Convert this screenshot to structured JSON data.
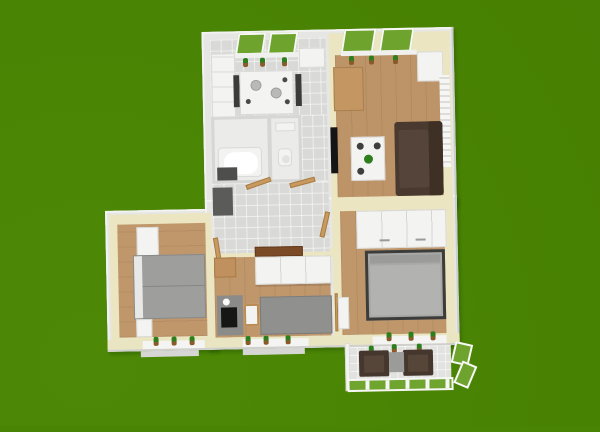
{
  "scene": {
    "view": "3d-aerial-floorplan-render",
    "background_color": "#4a8404",
    "palette": {
      "lawn_green": "#4a8404",
      "window_glass_green": "#6ea32e",
      "exterior_wall_gray": "#e6e6e4",
      "interior_wall_cream": "#ebe6c1",
      "tile_floor_gray": "#d9d9d7",
      "bath_floor_white": "#ebebe9",
      "wood_floor_oak": "#c0966b",
      "sofa_dark_brown": "#4a392f",
      "bed_gray": "#a5a5a3",
      "furniture_white": "#f3f3f1",
      "door_wood_tan": "#c89a5f",
      "plant_green": "#2f7e1e",
      "plant_pot_brown": "#8a5a2b",
      "doormat_brown": "#7b4a27",
      "hall_wardrobe_dark_gray": "#5b5b59",
      "tv_black": "#151515",
      "balcony_chair_brown": "#45372d"
    },
    "rooms": [
      {
        "name": "kitchen",
        "floor": "gray-tile",
        "items": [
          "wall-cabinets",
          "upper-cabinet",
          "dining-table",
          "2 chairs",
          "2 plates",
          "3 cups",
          "2 green-view windows",
          "3 windowsill cactus plants"
        ]
      },
      {
        "name": "living-room",
        "floor": "wood",
        "items": [
          "wooden-sideboard",
          "wall-tv",
          "dark-brown-sofa",
          "white-coffee-table",
          "table-plant",
          "radiator",
          "white-cabinet",
          "2 green-view windows",
          "3 windowsill plants"
        ]
      },
      {
        "name": "bathroom",
        "floor": "white",
        "items": [
          "bathtub",
          "dark-bath-mat"
        ]
      },
      {
        "name": "wc",
        "floor": "white",
        "items": [
          "toilet",
          "small-sink"
        ]
      },
      {
        "name": "hallway",
        "floor": "gray-tile",
        "items": [
          "dark-wardrobe",
          "brown-doormat",
          "4 open wooden doors"
        ]
      },
      {
        "name": "bedroom-left",
        "floor": "wood",
        "items": [
          "gray-double-bed",
          "2 white nightstands",
          "3 windowsill plants"
        ]
      },
      {
        "name": "bedroom-middle",
        "floor": "wood",
        "items": [
          "white-wardrobe",
          "corner-shelf",
          "gray-desk",
          "black-monitor",
          "wooden-chair",
          "gray-bed",
          "3 windowsill plants"
        ]
      },
      {
        "name": "bedroom-right",
        "floor": "wood",
        "items": [
          "white-wardrobe-with-handles",
          "dark-framed-double-bed",
          "white-door",
          "3 windowsill plants"
        ]
      },
      {
        "name": "balcony",
        "floor": "light-tile",
        "items": [
          "2 dark armchairs",
          "gray-side-table",
          "green-glass-railing",
          "open-casement-window",
          "3 sill plants"
        ]
      }
    ]
  }
}
